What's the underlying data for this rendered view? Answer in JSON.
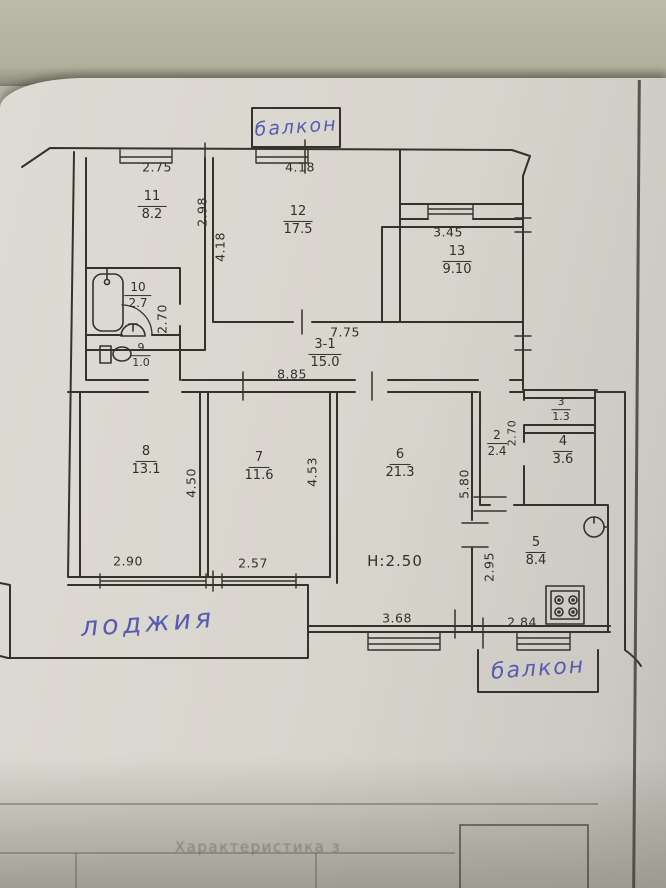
{
  "plan": {
    "balcony_top_label": "балкон",
    "balcony_bottom_label": "балкон",
    "loggia_label": "лоджия",
    "height_label": "H:2.50",
    "footer_text": "Характеристика з",
    "rooms": {
      "r11": {
        "num": "11",
        "area": "8.2"
      },
      "r12": {
        "num": "12",
        "area": "17.5"
      },
      "r13": {
        "num": "13",
        "area": "9.10"
      },
      "r10": {
        "num": "10",
        "area": "2.7"
      },
      "r9": {
        "num": "9",
        "area": "1.0"
      },
      "corridor": {
        "num": "3-1",
        "area": "15.0"
      },
      "r8": {
        "num": "8",
        "area": "13.1"
      },
      "r7": {
        "num": "7",
        "area": "11.6"
      },
      "r6": {
        "num": "6",
        "area": "21.3"
      },
      "r2": {
        "num": "2",
        "area": "2.4"
      },
      "r3": {
        "num": "3",
        "area": "1.3"
      },
      "r4": {
        "num": "4",
        "area": "3.6"
      },
      "r5": {
        "num": "5",
        "area": "8.4"
      }
    },
    "dims": {
      "room11_top": "2.75",
      "balcony_window": "4.18",
      "room11_right": "2.98",
      "room12_left": "4.18",
      "room13_top": "3.45",
      "bath_corridor": "2.70",
      "corridor_top": "7.75",
      "corridor_bottom": "8.85",
      "room8_height": "4.50",
      "room7_height": "4.53",
      "room6_height": "5.80",
      "room2_height": "2.70",
      "room8_bottom": "2.90",
      "room7_bottom": "2.57",
      "kitchen_left": "2.95",
      "room6_window": "3.68",
      "kitchen_window": "2.84"
    },
    "colors": {
      "ink": "#33302b",
      "blue_ink": "#575cb0",
      "paper": "#d8d5cd",
      "table_surface": "#b9b7a6"
    }
  }
}
